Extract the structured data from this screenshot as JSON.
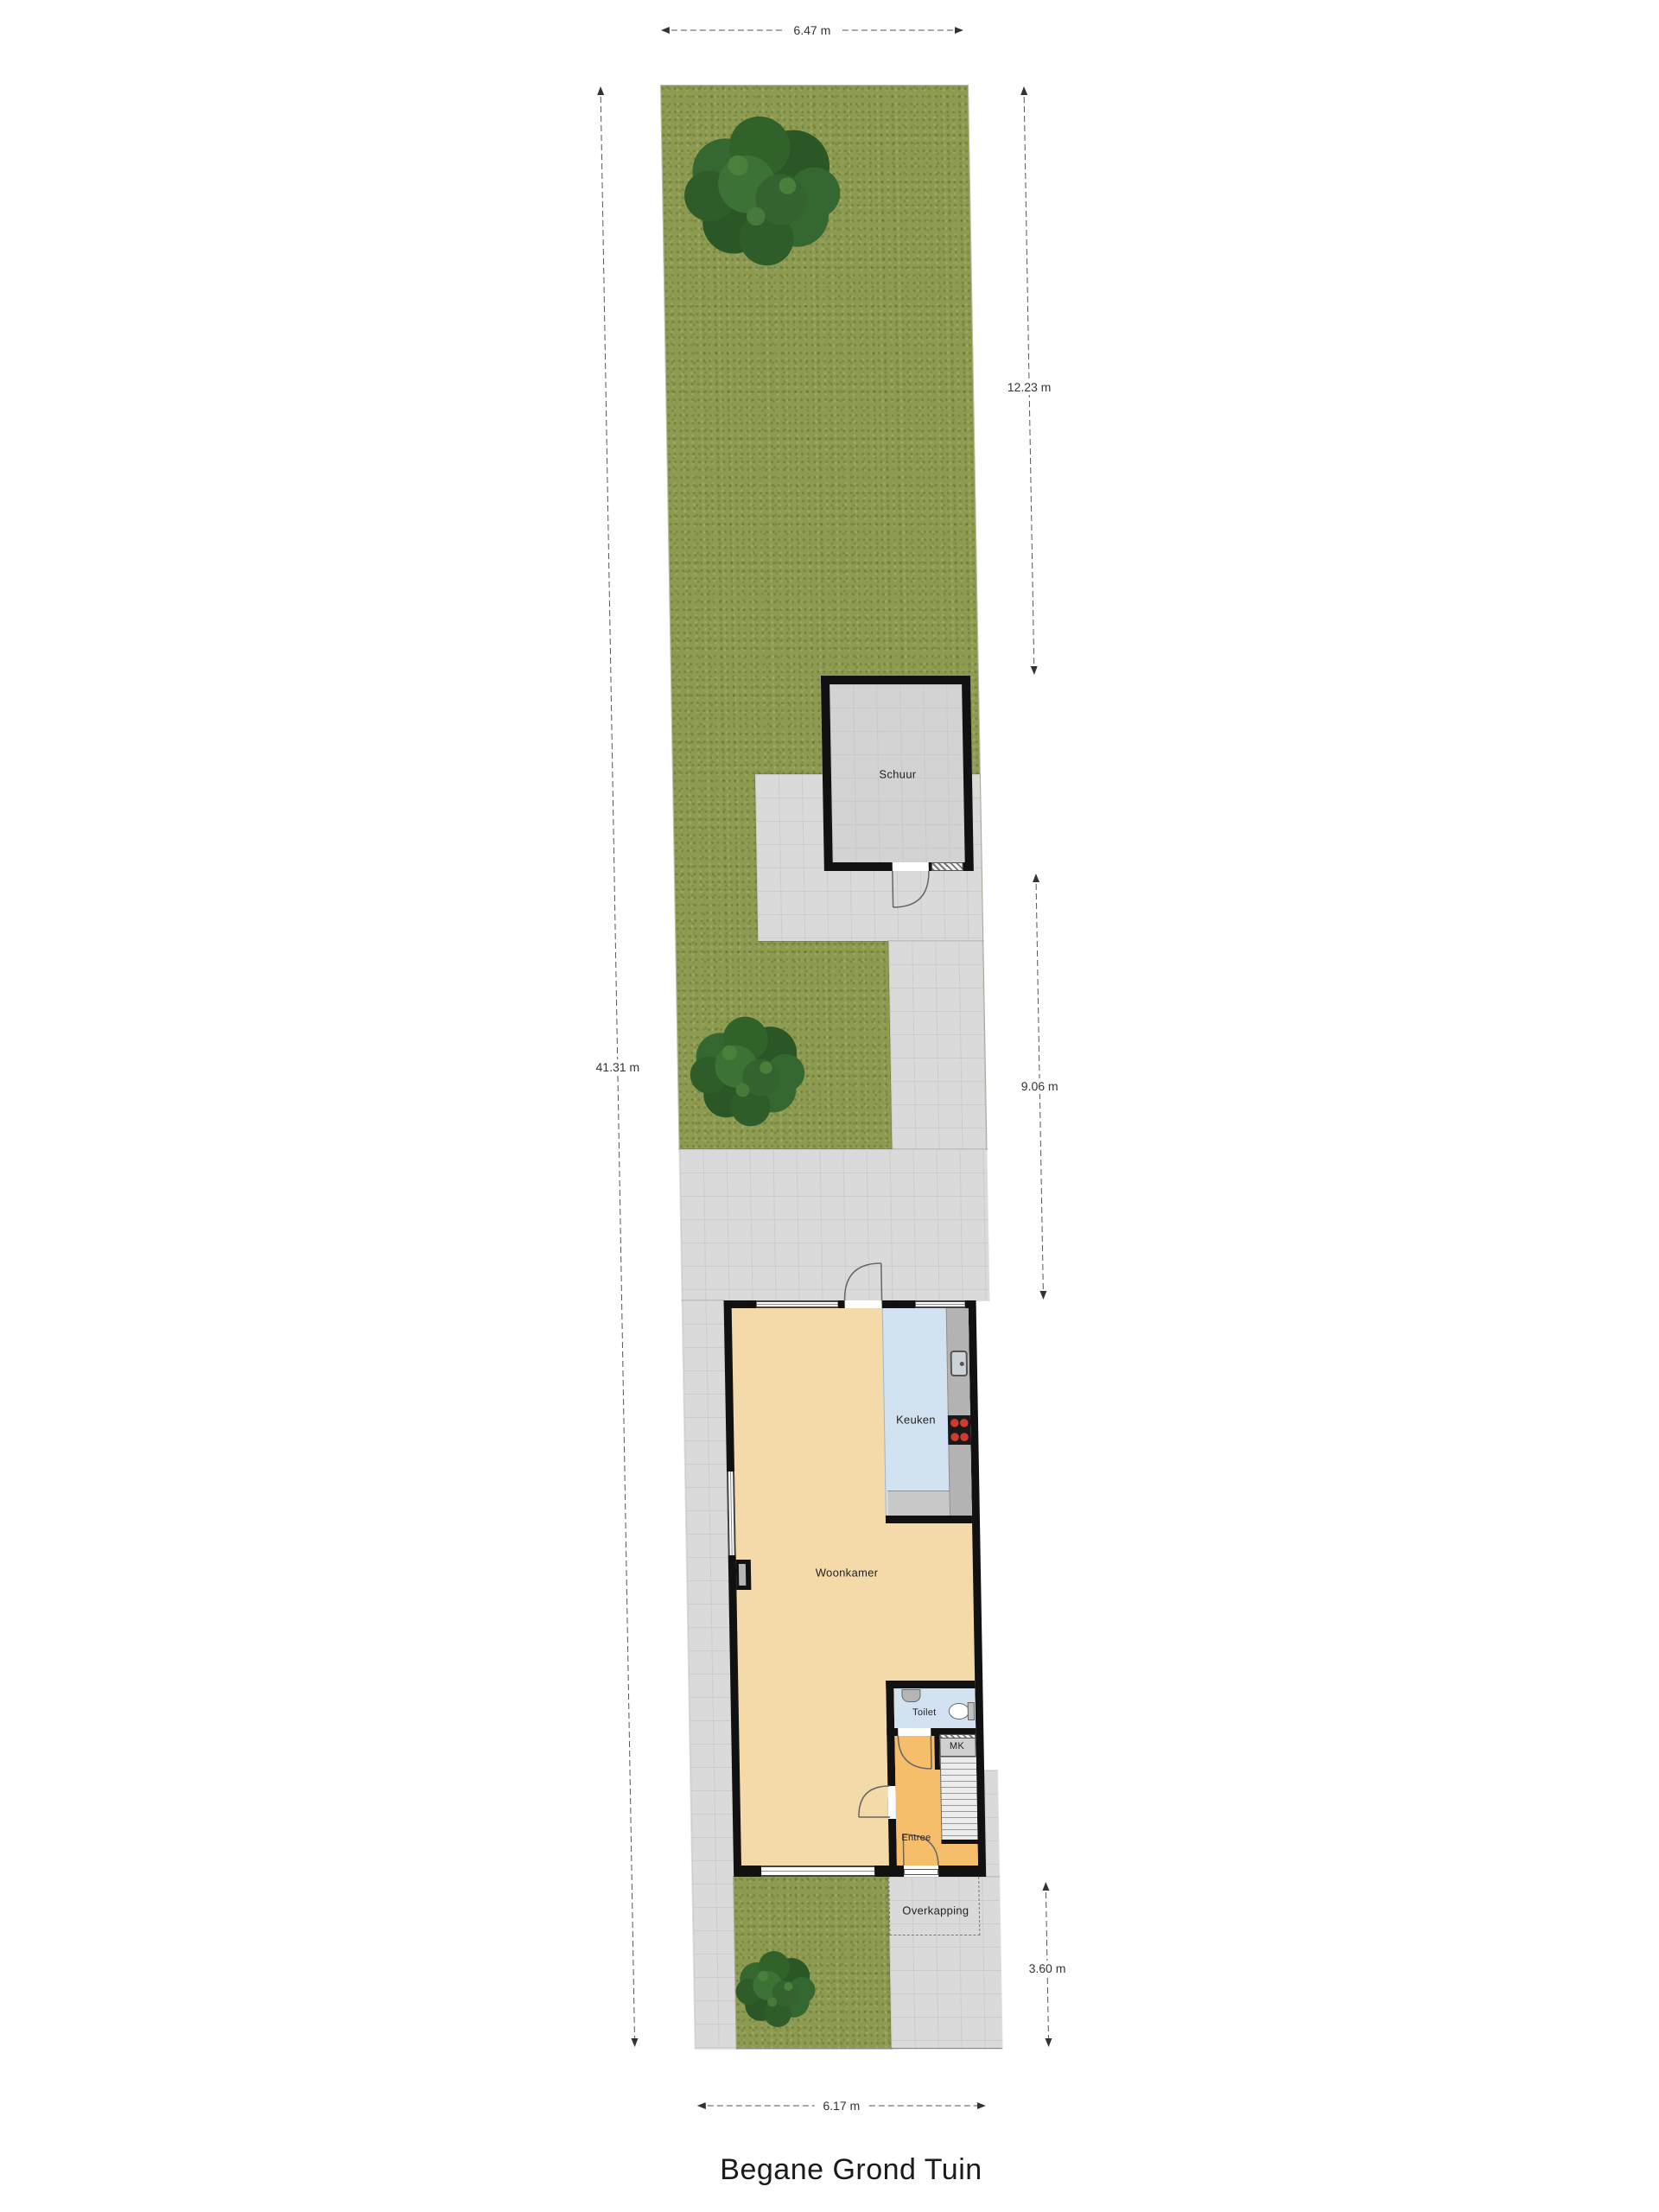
{
  "title": "Begane Grond Tuin",
  "rooms": {
    "schuur": "Schuur",
    "keuken": "Keuken",
    "woonkamer": "Woonkamer",
    "toilet": "Toilet",
    "mk": "MK",
    "entree": "Entree",
    "overkapping": "Overkapping"
  },
  "dimensions": {
    "plot_top_width": "6.47 m",
    "upper_garden_length": "12.23 m",
    "plot_length": "41.31 m",
    "middle_garden_length": "9.06 m",
    "front_garden_length": "3.60 m",
    "plot_bottom_width": "6.17 m"
  },
  "icons": {
    "trees": "tree-icon",
    "kitchen_sink": "sink-icon",
    "cooktop": "cooktop-icon",
    "wc": "toilet-bowl-icon",
    "stairs": "stairs-icon"
  },
  "colors": {
    "lawn": "#8D9B51",
    "tree": "#2E5D29",
    "paving": "#DADADA",
    "wall": "#111111",
    "shed_floor": "#D3D3D3",
    "living_floor": "#F3DAA8",
    "kitchen_floor": "#D3E2F0",
    "hall_floor": "#F6BE6B",
    "counter": "#B3B3B3",
    "cabinets": "#C8C8C8",
    "burner": "#D23B2B",
    "stairs": "#ECECEC"
  }
}
